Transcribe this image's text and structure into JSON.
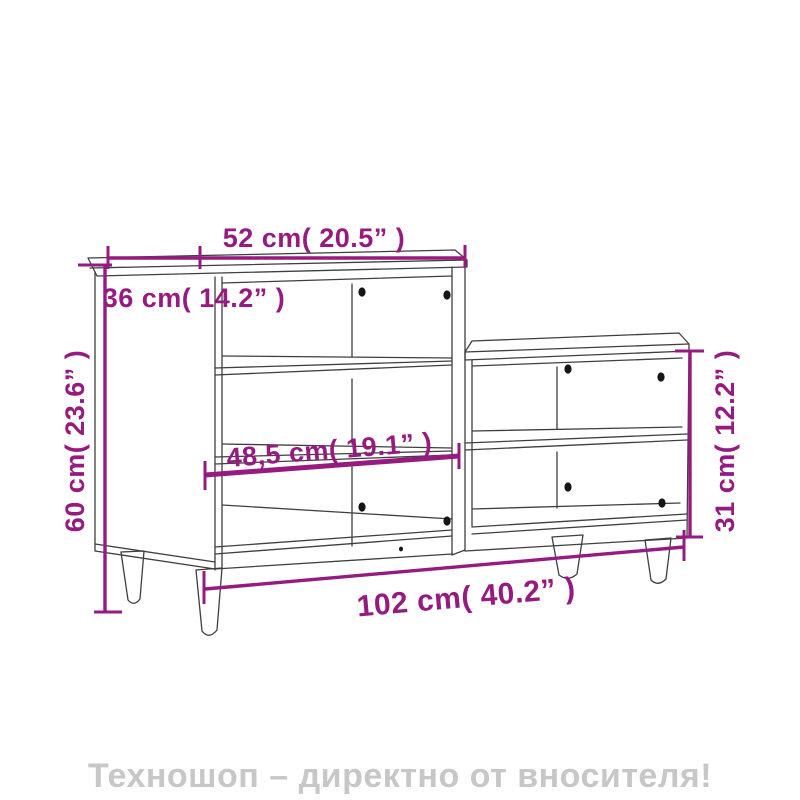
{
  "diagram": {
    "labels": {
      "top_width": "52 cm( 20.5” )",
      "depth": "36 cm( 14.2” )",
      "height": "60 cm( 23.6” )",
      "inner_width": "48,5 cm( 19.1” )",
      "total_width": "102 cm( 40.2” )",
      "right_height": "31 cm( 12.2” )"
    }
  },
  "footer": {
    "text": "Техношоп – директно от вносителя!"
  },
  "colors": {
    "dimension_purple": "#951b81",
    "drawing_line": "#3f3f3f",
    "footer_gray": "#c7c7c7",
    "background": "#ffffff"
  }
}
